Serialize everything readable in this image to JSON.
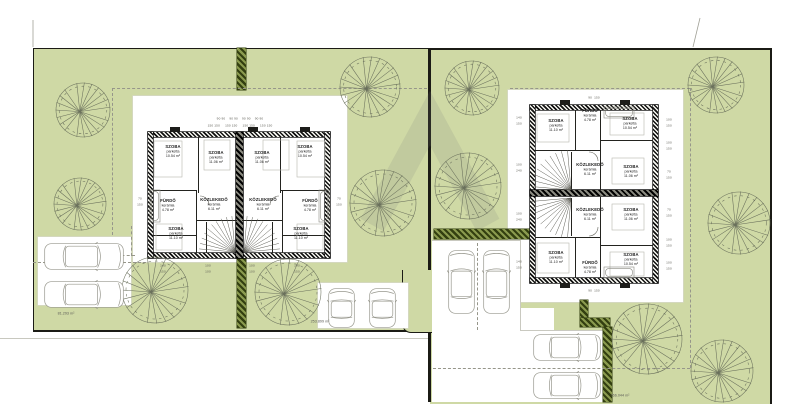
{
  "title": "Ikerház helyszínrajz / alaprajz (duplex site plan)",
  "colors": {
    "grass": "#cfd9a5",
    "hedge_dark": "#333f10",
    "plot_border": "#1b1b15",
    "wall": "#101010",
    "car_stroke": "#98988e",
    "tree_stroke": "#6a705c",
    "dim_text": "#5a5a52"
  },
  "areas": [
    {
      "x": 66,
      "y": 314,
      "text": "81.293 m²"
    },
    {
      "x": 320,
      "y": 322,
      "text": "253.899 m²"
    },
    {
      "x": 620,
      "y": 396,
      "text": "766.044 m²"
    }
  ],
  "left_building": {
    "rooms": [
      {
        "name": "SZOBA",
        "floor": "parketta",
        "area": "10.54 m²",
        "x": 173,
        "y": 152
      },
      {
        "name": "SZOBA",
        "floor": "parketta",
        "area": "11.06 m²",
        "x": 216,
        "y": 158
      },
      {
        "name": "SZOBA",
        "floor": "parketta",
        "area": "11.06 m²",
        "x": 262,
        "y": 158
      },
      {
        "name": "SZOBA",
        "floor": "parketta",
        "area": "10.54 m²",
        "x": 305,
        "y": 152
      },
      {
        "name": "FÜRDŐ",
        "floor": "kerámia",
        "area": "4.78 m²",
        "x": 168,
        "y": 206
      },
      {
        "name": "KÖZLEKEDŐ",
        "floor": "kerámia",
        "area": "6.11 m²",
        "x": 214,
        "y": 205
      },
      {
        "name": "KÖZLEKEDŐ",
        "floor": "kerámia",
        "area": "6.11 m²",
        "x": 263,
        "y": 205
      },
      {
        "name": "FÜRDŐ",
        "floor": "kerámia",
        "area": "4.78 m²",
        "x": 310,
        "y": 206
      },
      {
        "name": "SZOBA",
        "floor": "parketta",
        "area": "11.10 m²",
        "x": 176,
        "y": 234
      },
      {
        "name": "SZOBA",
        "floor": "parketta",
        "area": "11.10 m²",
        "x": 301,
        "y": 234
      }
    ]
  },
  "right_building": {
    "rooms": [
      {
        "name": "SZOBA",
        "floor": "parketta",
        "area": "11.10 m²",
        "x": 556,
        "y": 126
      },
      {
        "name": "FÜRDŐ",
        "floor": "kerámia",
        "area": "4.78 m²",
        "x": 590,
        "y": 116
      },
      {
        "name": "SZOBA",
        "floor": "parketta",
        "area": "10.54 m²",
        "x": 630,
        "y": 124
      },
      {
        "name": "KÖZLEKEDŐ",
        "floor": "kerámia",
        "area": "6.11 m²",
        "x": 590,
        "y": 170
      },
      {
        "name": "SZOBA",
        "floor": "parketta",
        "area": "11.06 m²",
        "x": 631,
        "y": 172
      },
      {
        "name": "KÖZLEKEDŐ",
        "floor": "kerámia",
        "area": "6.11 m²",
        "x": 590,
        "y": 215
      },
      {
        "name": "SZOBA",
        "floor": "parketta",
        "area": "11.06 m²",
        "x": 631,
        "y": 215
      },
      {
        "name": "SZOBA",
        "floor": "parketta",
        "area": "11.10 m²",
        "x": 556,
        "y": 258
      },
      {
        "name": "FÜRDŐ",
        "floor": "kerámia",
        "area": "4.78 m²",
        "x": 590,
        "y": 268
      },
      {
        "name": "SZOBA",
        "floor": "parketta",
        "area": "10.54 m²",
        "x": 631,
        "y": 260
      }
    ]
  },
  "dims": [
    {
      "x": 240,
      "y": 119,
      "t": "90 90    90 90    90 90    90 90"
    },
    {
      "x": 240,
      "y": 126,
      "t": "150 150     150 150     150 150     150 150"
    },
    {
      "x": 140,
      "y": 199,
      "t": "70"
    },
    {
      "x": 140,
      "y": 205,
      "t": "150"
    },
    {
      "x": 339,
      "y": 199,
      "t": "70"
    },
    {
      "x": 339,
      "y": 205,
      "t": "150"
    },
    {
      "x": 163,
      "y": 266,
      "t": "140"
    },
    {
      "x": 163,
      "y": 272,
      "t": "150"
    },
    {
      "x": 208,
      "y": 266,
      "t": "100"
    },
    {
      "x": 208,
      "y": 272,
      "t": "100"
    },
    {
      "x": 252,
      "y": 266,
      "t": "100"
    },
    {
      "x": 252,
      "y": 272,
      "t": "100"
    },
    {
      "x": 297,
      "y": 266,
      "t": "140"
    },
    {
      "x": 297,
      "y": 272,
      "t": "150"
    },
    {
      "x": 519,
      "y": 118,
      "t": "140"
    },
    {
      "x": 519,
      "y": 124,
      "t": "150"
    },
    {
      "x": 519,
      "y": 165,
      "t": "100"
    },
    {
      "x": 519,
      "y": 171,
      "t": "240"
    },
    {
      "x": 519,
      "y": 214,
      "t": "100"
    },
    {
      "x": 519,
      "y": 220,
      "t": "240"
    },
    {
      "x": 519,
      "y": 262,
      "t": "140"
    },
    {
      "x": 519,
      "y": 268,
      "t": "150"
    },
    {
      "x": 669,
      "y": 120,
      "t": "100"
    },
    {
      "x": 669,
      "y": 126,
      "t": "150"
    },
    {
      "x": 669,
      "y": 143,
      "t": "100"
    },
    {
      "x": 669,
      "y": 149,
      "t": "150"
    },
    {
      "x": 669,
      "y": 172,
      "t": "70"
    },
    {
      "x": 669,
      "y": 178,
      "t": "150"
    },
    {
      "x": 669,
      "y": 210,
      "t": "70"
    },
    {
      "x": 669,
      "y": 216,
      "t": "150"
    },
    {
      "x": 669,
      "y": 240,
      "t": "100"
    },
    {
      "x": 669,
      "y": 246,
      "t": "150"
    },
    {
      "x": 669,
      "y": 263,
      "t": "100"
    },
    {
      "x": 669,
      "y": 269,
      "t": "150"
    },
    {
      "x": 594,
      "y": 98,
      "t": "90  150"
    },
    {
      "x": 594,
      "y": 291,
      "t": "90  150"
    }
  ],
  "scene": {
    "rects": [
      [
        "plotL",
        33,
        48,
        394,
        281,
        "left-plot-grass"
      ],
      [
        "plotR",
        430,
        48,
        340,
        354,
        "right-plot-grass"
      ],
      [
        "solid",
        428,
        48,
        3,
        354,
        "plot-divider"
      ],
      [
        "patch",
        402,
        270,
        38,
        62,
        "garden-patch"
      ],
      [
        "white",
        133,
        96,
        214,
        166,
        "left-courtyard"
      ],
      [
        "white",
        38,
        237,
        93,
        68,
        "left-parking-area"
      ],
      [
        "white",
        318,
        283,
        90,
        45,
        "left-south-parking"
      ],
      [
        "white",
        508,
        90,
        175,
        212,
        "right-courtyard"
      ],
      [
        "white0",
        432,
        240,
        88,
        162,
        "right-driveway-vertical"
      ],
      [
        "white0",
        432,
        330,
        173,
        72,
        "right-driveway-horizontal"
      ],
      [
        "white0",
        518,
        308,
        36,
        24,
        "right-driveway-notch"
      ],
      [
        "lineG",
        520,
        240,
        1,
        90,
        "driveway-edge"
      ],
      [
        "lineG",
        432,
        240,
        88,
        1,
        "driveway-edge"
      ],
      [
        "lineG",
        520,
        330,
        86,
        1,
        "driveway-edge"
      ],
      [
        "lineG",
        605,
        330,
        1,
        72,
        "driveway-edge"
      ],
      [
        "hedge",
        237,
        48,
        9,
        42,
        "hedge-strip"
      ],
      [
        "hedge",
        237,
        258,
        9,
        70,
        "hedge-strip"
      ],
      [
        "hedge",
        434,
        229,
        101,
        10,
        "hedge-strip"
      ],
      [
        "hedge",
        580,
        300,
        8,
        22,
        "hedge-strip"
      ],
      [
        "hedge",
        580,
        318,
        30,
        9,
        "hedge-strip"
      ],
      [
        "hedge",
        603,
        327,
        9,
        75,
        "hedge-strip"
      ],
      [
        "line",
        0,
        338,
        428,
        1,
        "street-edge"
      ],
      [
        "dashH",
        112,
        88,
        315,
        1,
        "boundary-dashed"
      ],
      [
        "dashV",
        112,
        88,
        1,
        147,
        "boundary-dashed"
      ],
      [
        "dashH",
        95,
        255,
        40,
        1,
        "boundary-dashed"
      ],
      [
        "dashV",
        131,
        226,
        1,
        30,
        "boundary-dashed"
      ],
      [
        "dashH",
        33,
        262,
        113,
        1,
        "boundary-dashed"
      ],
      [
        "dashH",
        510,
        88,
        180,
        1,
        "boundary-dashed"
      ],
      [
        "dashV",
        690,
        88,
        1,
        280,
        "boundary-dashed"
      ],
      [
        "dashH",
        433,
        368,
        257,
        1,
        "boundary-dashed"
      ],
      [
        "dashV",
        477,
        243,
        1,
        87,
        "boundary-dashed"
      ],
      [
        "wall",
        148,
        132,
        182,
        5,
        "left-building-wall"
      ],
      [
        "wall",
        148,
        253,
        182,
        5,
        "left-building-wall"
      ],
      [
        "wall",
        148,
        132,
        5,
        126,
        "left-building-wall"
      ],
      [
        "wall",
        325,
        132,
        5,
        126,
        "left-building-wall"
      ],
      [
        "pwall",
        236,
        132,
        7,
        126,
        "left-party-wall"
      ],
      [
        "stub",
        170,
        127,
        10,
        5,
        "wall-stub"
      ],
      [
        "stub",
        248,
        127,
        10,
        5,
        "wall-stub"
      ],
      [
        "stub",
        300,
        127,
        10,
        5,
        "wall-stub"
      ],
      [
        "iwall",
        198,
        137,
        1,
        56,
        "interior-wall"
      ],
      [
        "iwall",
        280,
        137,
        1,
        56,
        "interior-wall"
      ],
      [
        "iwall",
        153,
        190,
        44,
        1,
        "interior-wall"
      ],
      [
        "iwall",
        281,
        190,
        44,
        1,
        "interior-wall"
      ],
      [
        "iwall",
        196,
        190,
        1,
        63,
        "interior-wall"
      ],
      [
        "iwall",
        282,
        190,
        1,
        63,
        "interior-wall"
      ],
      [
        "iwall",
        153,
        235,
        43,
        1,
        "interior-wall"
      ],
      [
        "iwall",
        283,
        235,
        42,
        1,
        "interior-wall"
      ],
      [
        "iwall",
        196,
        220,
        41,
        1,
        "interior-wall"
      ],
      [
        "iwall",
        242,
        220,
        41,
        1,
        "interior-wall"
      ],
      [
        "iwall",
        206,
        222,
        1,
        31,
        "interior-wall"
      ],
      [
        "iwall",
        272,
        222,
        1,
        31,
        "interior-wall"
      ],
      [
        "wall",
        530,
        105,
        128,
        5,
        "right-building-wall"
      ],
      [
        "wall",
        530,
        278,
        128,
        5,
        "right-building-wall"
      ],
      [
        "wall",
        530,
        105,
        5,
        178,
        "right-building-wall"
      ],
      [
        "wall",
        653,
        105,
        5,
        178,
        "right-building-wall"
      ],
      [
        "pwall",
        530,
        190,
        128,
        6,
        "right-party-wall"
      ],
      [
        "stub",
        560,
        100,
        10,
        5,
        "wall-stub"
      ],
      [
        "stub",
        620,
        100,
        10,
        5,
        "wall-stub"
      ],
      [
        "stub",
        560,
        283,
        10,
        5,
        "wall-stub"
      ],
      [
        "stub",
        620,
        283,
        10,
        5,
        "wall-stub"
      ],
      [
        "iwall",
        600,
        110,
        1,
        80,
        "interior-wall"
      ],
      [
        "iwall",
        600,
        140,
        53,
        1,
        "interior-wall"
      ],
      [
        "iwall",
        535,
        150,
        66,
        1,
        "interior-wall"
      ],
      [
        "iwall",
        575,
        110,
        1,
        41,
        "interior-wall"
      ],
      [
        "iwall",
        600,
        197,
        1,
        81,
        "interior-wall"
      ],
      [
        "iwall",
        600,
        245,
        53,
        1,
        "interior-wall"
      ],
      [
        "iwall",
        535,
        237,
        66,
        1,
        "interior-wall"
      ],
      [
        "iwall",
        575,
        237,
        1,
        41,
        "interior-wall"
      ],
      [
        "iwall",
        571,
        152,
        1,
        38,
        "interior-wall"
      ],
      [
        "iwall",
        571,
        198,
        1,
        38,
        "interior-wall"
      ]
    ],
    "trees": [
      [
        83,
        110,
        27
      ],
      [
        80,
        204,
        26
      ],
      [
        155,
        290,
        33
      ],
      [
        288,
        292,
        33
      ],
      [
        370,
        87,
        30
      ],
      [
        383,
        203,
        33
      ],
      [
        472,
        88,
        27
      ],
      [
        468,
        186,
        33
      ],
      [
        716,
        85,
        28
      ],
      [
        739,
        223,
        31
      ],
      [
        647,
        339,
        35
      ],
      [
        722,
        371,
        31
      ]
    ],
    "cars": [
      {
        "x": 44,
        "y": 242,
        "dir": "h",
        "len": 80
      },
      {
        "x": 44,
        "y": 280,
        "dir": "h",
        "len": 80
      },
      {
        "x": 327,
        "y": 288,
        "dir": "v",
        "len": 40
      },
      {
        "x": 368,
        "y": 288,
        "dir": "v",
        "len": 40
      },
      {
        "x": 447,
        "y": 250,
        "dir": "v",
        "len": 64
      },
      {
        "x": 482,
        "y": 250,
        "dir": "v",
        "len": 64
      },
      {
        "x": 533,
        "y": 333,
        "dir": "h",
        "len": 68
      },
      {
        "x": 533,
        "y": 371,
        "dir": "h",
        "len": 68
      }
    ],
    "stairs": [
      {
        "fx": 235,
        "fy": 252,
        "a0": 185,
        "a1": 265,
        "r": 36
      },
      {
        "fx": 244,
        "fy": 252,
        "a0": 275,
        "a1": 355,
        "r": 36
      },
      {
        "fx": 571,
        "fy": 190,
        "a0": 185,
        "a1": 265,
        "r": 40
      },
      {
        "fx": 571,
        "fy": 198,
        "a0": 95,
        "a1": 175,
        "r": 40
      }
    ],
    "arcs": [
      "M 200 196 A 9 9 0 0 1 209 205",
      "M 279 196 A 9 9 0 0 0 270 205",
      "M 589 152 A 9 9 0 0 1 598 161",
      "M 589 236 A 9 9 0 0 0 598 227"
    ],
    "furniture": [
      [
        154,
        141,
        28,
        36
      ],
      [
        204,
        140,
        26,
        30
      ],
      [
        263,
        140,
        26,
        30
      ],
      [
        297,
        141,
        28,
        36
      ],
      [
        156,
        224,
        26,
        26
      ],
      [
        297,
        224,
        26,
        26
      ],
      [
        537,
        114,
        32,
        28
      ],
      [
        610,
        113,
        34,
        22
      ],
      [
        612,
        158,
        32,
        26
      ],
      [
        612,
        204,
        32,
        26
      ],
      [
        537,
        243,
        32,
        30
      ],
      [
        610,
        252,
        34,
        24
      ]
    ],
    "tubs": [
      [
        150,
        190,
        10,
        32
      ],
      [
        319,
        190,
        10,
        32
      ],
      [
        604,
        107,
        30,
        11
      ],
      [
        604,
        267,
        30,
        11
      ]
    ],
    "ticks": [
      [
        33,
        20,
        33,
        47
      ],
      [
        700,
        18,
        693,
        47
      ]
    ],
    "watermark_points": "372,225 430,118 488,225"
  }
}
